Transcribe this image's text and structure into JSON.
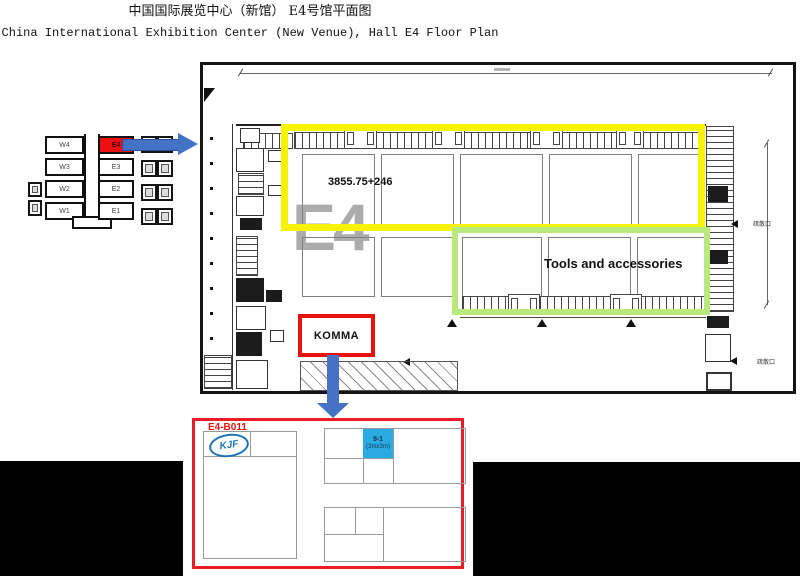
{
  "title": {
    "zh": "中国国际展览中心（新馆） E4号馆平面图",
    "en": "China International Exhibition Center (New Venue),  Hall E4 Floor Plan"
  },
  "minimap": {
    "west_halls": [
      "W4",
      "W3",
      "W2",
      "W1"
    ],
    "east_halls": [
      "E4",
      "E3",
      "E2",
      "E1"
    ],
    "highlighted_hall": "E4"
  },
  "plan": {
    "watermark": "E4",
    "area_note": "3855.75+246",
    "zone_label": "Tools and accessories",
    "booth_label": "KOMMA",
    "exit_label": "疏散口"
  },
  "detail": {
    "booth_id": "E4-B011",
    "logo": "KJF",
    "cell_id": "9-1",
    "cell_size": "(3mx3m)"
  },
  "colors": {
    "highlight_yellow": "#F8F400",
    "highlight_green": "#B9E97C",
    "marker_red": "#E8120C",
    "arrow_blue": "#4472C4",
    "cell_blue": "#29ABE2",
    "logo_blue": "#1B75BB",
    "hall_red": "#EE1010",
    "watermark_gray": "#ACACAC"
  }
}
